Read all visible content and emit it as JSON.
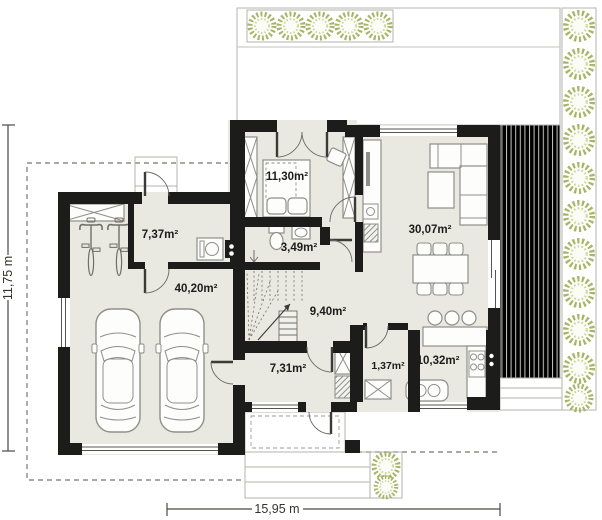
{
  "plan_title": "House ground floor plan",
  "rooms": {
    "utility": "7,37m²",
    "bedroom": "11,30m²",
    "bathroom": "3,49m²",
    "living": "30,07m²",
    "garage": "40,20m²",
    "hall": "9,40m²",
    "entrance": "7,31m²",
    "pantry": "1,37m²",
    "kitchen": "10,32m²"
  },
  "dimensions": {
    "width": "15,95 m",
    "height": "11,75 m"
  },
  "colors": {
    "wall": "#1c1c1a",
    "floor": "#e9e9e1",
    "deck_line": "#cbcbc5",
    "plant_green": "#a8b46a",
    "furniture_outline": "#8f8f8a"
  }
}
